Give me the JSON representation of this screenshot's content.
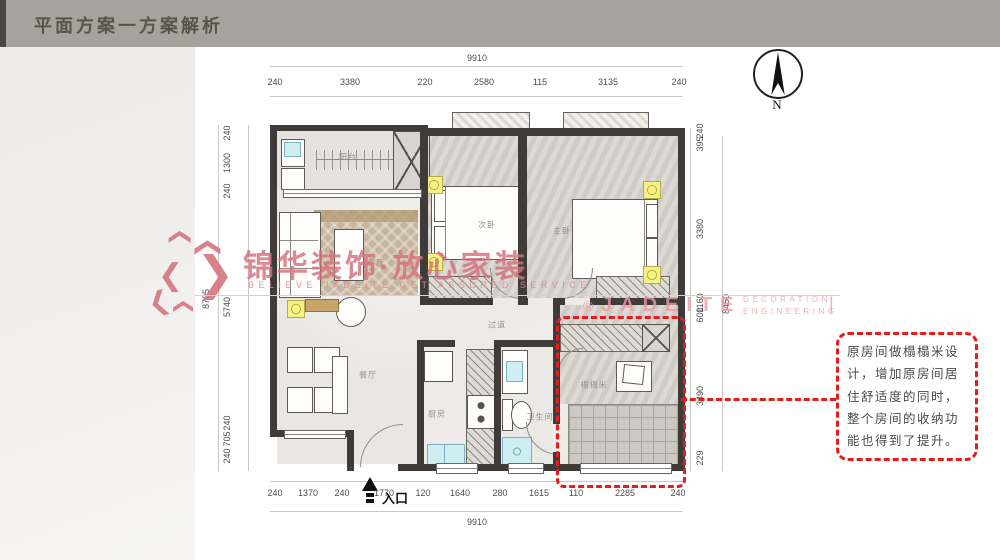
{
  "header": {
    "title": "平面方案一方案解析"
  },
  "compass": {
    "label": "N"
  },
  "entrance": {
    "label": "入口"
  },
  "rooms": {
    "balcony": "阳台",
    "living": "客厅",
    "bedroom2": "次卧",
    "master": "主卧",
    "corridor": "过道",
    "dining": "餐厅",
    "kitchen": "厨房",
    "bathroom": "卫生间",
    "tatami": "榻榻米"
  },
  "dimensions": {
    "top": {
      "overall": "9910",
      "segments": [
        "240",
        "3380",
        "220",
        "2580",
        "115",
        "3135",
        "240"
      ]
    },
    "bottom": {
      "overall": "9910",
      "segments": [
        "240",
        "1370",
        "240",
        "1770",
        "120",
        "1640",
        "280",
        "1615",
        "110",
        "2285",
        "240"
      ]
    },
    "left": {
      "overall": "8705",
      "segments": [
        "240",
        "1300",
        "240",
        "5740",
        "240",
        "705",
        "240"
      ]
    },
    "right": {
      "overall": "8450",
      "segments": [
        "240",
        "395",
        "3380",
        "1160",
        "600",
        "3490",
        "229"
      ]
    }
  },
  "watermark_center": {
    "brand": "锦华装饰·放心家装",
    "slogan": "BELIEVE JADEITE,GET ASSURED SERVICE"
  },
  "watermark_right": {
    "reg": "®",
    "brand": "JADEITE",
    "line1": "DECORATION",
    "line2": "ENGINEERING",
    "divider": "|"
  },
  "annotation": {
    "text": "原房间做榻榻米设计，增加原房间居住舒适度的同时，整个房间的收纳功能也得到了提升。"
  },
  "colors": {
    "accent_red": "#e31c1c",
    "watermark_pink": "#d4717c",
    "wall": "#3f3b38",
    "light_yellow": "#f6f282"
  }
}
